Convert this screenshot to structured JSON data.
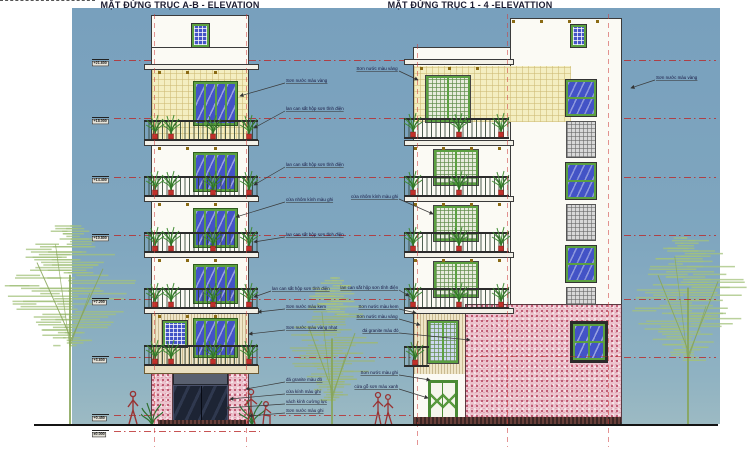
{
  "titles": {
    "left": "MẶT ĐỨNG TRỤC A-B - ELEVATION",
    "right": "MẶT ĐỨNG TRỤC 1 - 4 -ELEVATTION"
  },
  "levels": [
    {
      "label": "+21.600",
      "y": 60,
      "end": 716
    },
    {
      "label": "+18.000",
      "y": 118,
      "end": 716
    },
    {
      "label": "+14.400",
      "y": 177,
      "end": 716
    },
    {
      "label": "+10.800",
      "y": 235,
      "end": 716
    },
    {
      "label": "+7.200",
      "y": 299,
      "end": 716
    },
    {
      "label": "+3.600",
      "y": 357,
      "end": 716
    },
    {
      "label": "+0.450",
      "y": 415,
      "end": 620
    },
    {
      "label": "±0.000",
      "y": 431,
      "end": 260
    }
  ],
  "annotations": [
    {
      "text": "Sơn nước màu vàng",
      "anchor": "left",
      "x": 286,
      "y": 82,
      "tx": 240,
      "ty": 96
    },
    {
      "text": "lan can sắt hộp sơn tĩnh điện",
      "anchor": "left",
      "x": 286,
      "y": 110,
      "tx": 254,
      "ty": 128
    },
    {
      "text": "lan can sắt hộp sơn tĩnh điện",
      "anchor": "left",
      "x": 286,
      "y": 166,
      "tx": 254,
      "ty": 185
    },
    {
      "text": "cửa nhôm kính màu ghi",
      "anchor": "left",
      "x": 286,
      "y": 201,
      "tx": 236,
      "ty": 217
    },
    {
      "text": "lan can sắt hộp sơn tĩnh điện",
      "anchor": "left",
      "x": 286,
      "y": 236,
      "tx": 254,
      "ty": 242
    },
    {
      "text": "lan can sắt hộp sơn tĩnh điện",
      "anchor": "left",
      "x": 272,
      "y": 290,
      "tx": 254,
      "ty": 297
    },
    {
      "text": "Sơn nước màu kem",
      "anchor": "left",
      "x": 286,
      "y": 308,
      "tx": 258,
      "ty": 312
    },
    {
      "text": "Sơn nước màu vàng nhạt",
      "anchor": "left",
      "x": 286,
      "y": 329,
      "tx": 249,
      "ty": 334
    },
    {
      "text": "đá granite màu đỏ",
      "anchor": "left",
      "x": 286,
      "y": 381,
      "tx": 246,
      "ty": 389
    },
    {
      "text": "cửa kính màu ghi",
      "anchor": "left",
      "x": 286,
      "y": 393,
      "tx": 230,
      "ty": 399
    },
    {
      "text": "vách kính cường lực",
      "anchor": "left",
      "x": 286,
      "y": 403,
      "tx": 226,
      "ty": 408
    },
    {
      "text": "Sơn nước màu ghi",
      "anchor": "left",
      "x": 286,
      "y": 412,
      "tx": 249,
      "ty": 416
    },
    {
      "text": "Sơn nước màu vàng",
      "anchor": "right",
      "x": 398,
      "y": 70,
      "tx": 418,
      "ty": 80
    },
    {
      "text": "cửa nhôm kính màu ghi",
      "anchor": "right",
      "x": 398,
      "y": 198,
      "tx": 433,
      "ty": 214
    },
    {
      "text": "lan can sắt hộp sơn tĩnh điện",
      "anchor": "right",
      "x": 398,
      "y": 289,
      "tx": 409,
      "ty": 296
    },
    {
      "text": "Sơn nước màu kem",
      "anchor": "right",
      "x": 398,
      "y": 308,
      "tx": 416,
      "ty": 313
    },
    {
      "text": "Sơn nước màu vàng",
      "anchor": "right",
      "x": 398,
      "y": 318,
      "tx": 420,
      "ty": 325
    },
    {
      "text": "đá granite màu đỏ",
      "anchor": "right",
      "x": 398,
      "y": 332,
      "tx": 470,
      "ty": 340
    },
    {
      "text": "Sơn nước màu ghi",
      "anchor": "right",
      "x": 398,
      "y": 374,
      "tx": 430,
      "ty": 380
    },
    {
      "text": "cửa gỗ sơn màu xanh",
      "anchor": "right",
      "x": 398,
      "y": 388,
      "tx": 428,
      "ty": 398
    },
    {
      "text": "Sơn nước màu vàng",
      "anchor": "left",
      "x": 656,
      "y": 79,
      "tx": 631,
      "ty": 88
    }
  ],
  "colors": {
    "sky": "#7fa5bf",
    "wall_yellow": "#f4eec1",
    "wall_cream": "#efe6c8",
    "granite_pink": "#ecc4ce",
    "granite_speckle": "#b23a56",
    "frame_green": "#5ba041",
    "glass_blue": "#4353c6",
    "tree_green": "#a3c27c",
    "grid_red": "#cc4444",
    "ink": "#2a2a2a"
  }
}
